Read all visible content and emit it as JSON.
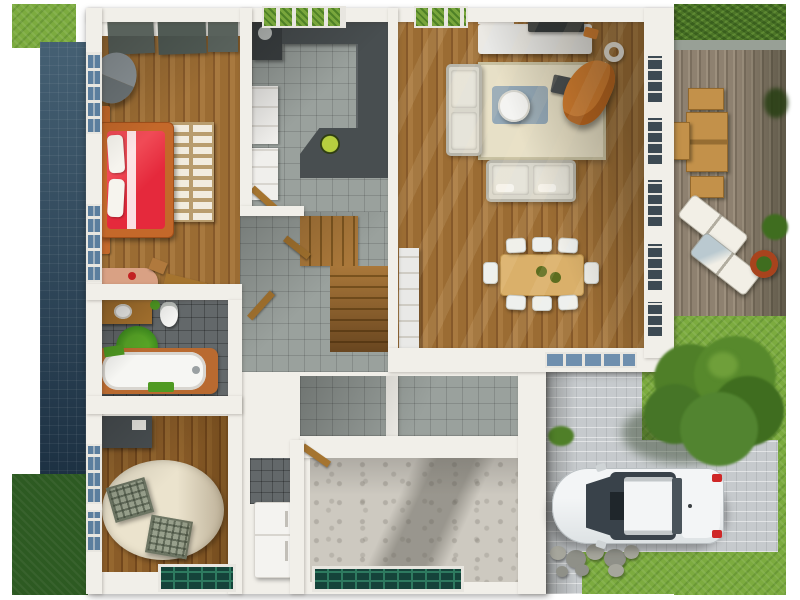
{
  "scene": {
    "type": "3d-floor-plan-render",
    "view": "top-down",
    "description": "Photoreal top-down render of a single-storey house interior with garden, wooden deck, driveway and parked white car",
    "rooms": [
      {
        "name": "bedroom",
        "floor": "wood",
        "furniture": [
          "double-bed-red",
          "nightstand",
          "nightstand",
          "armchair-gray",
          "slatted-dresser",
          "closet-panels",
          "desk",
          "wall-windows"
        ]
      },
      {
        "name": "kitchen",
        "floor": "gray-tile",
        "furniture": [
          "l-shaped-counter-dark",
          "island-dark",
          "white-cabinets",
          "cooktop",
          "green-bowl",
          "garden-windows"
        ]
      },
      {
        "name": "living-room",
        "floor": "wood",
        "furniture": [
          "tv-console",
          "tv",
          "corner-sofa-cream",
          "loveseat-cream",
          "round-coffee-table",
          "beige-rug",
          "blue-mat",
          "orange-chaise",
          "ottoman",
          "speaker-ring"
        ]
      },
      {
        "name": "dining-area",
        "floor": "wood",
        "furniture": [
          "wood-dining-table",
          "white-chairs-x8",
          "green-bowls"
        ]
      },
      {
        "name": "hallway-stairs",
        "floor": "gray-tile",
        "furniture": [
          "l-shaped-wood-staircase",
          "white-sideboard",
          "open-wood-doors"
        ]
      },
      {
        "name": "bathroom",
        "floor": "dark-tile",
        "furniture": [
          "bathtub-wood-surround",
          "vanity-sink",
          "toilet",
          "round-green-rug",
          "green-mat",
          "blue-towels"
        ]
      },
      {
        "name": "office-bedroom2",
        "floor": "wood",
        "furniture": [
          "oval-cream-rug",
          "plaid-chair",
          "plaid-chair",
          "dark-desk",
          "wall-windows",
          "teal-basement-window"
        ]
      },
      {
        "name": "utility-garage",
        "floor": "concrete",
        "furniture": [
          "fridge-white",
          "teal-basement-window"
        ]
      }
    ],
    "outdoor": [
      {
        "name": "hedge-top-right"
      },
      {
        "name": "wood-deck",
        "furniture": [
          "deck-dining-table",
          "deck-chairs-x3",
          "sun-lounger-white",
          "sun-lounger-white",
          "terracotta-planter"
        ]
      },
      {
        "name": "lawn"
      },
      {
        "name": "paver-driveway",
        "furniture": [
          "white-car",
          "stones",
          "tree",
          "bush"
        ]
      },
      {
        "name": "blue-side-strip"
      },
      {
        "name": "grass-corners"
      }
    ]
  },
  "palette": {
    "wall": "#f1efe9",
    "wood-1": "#9b6c33",
    "wood-2": "#86592a",
    "wood-3": "#a8793f",
    "wood-d1": "#8a5c28",
    "wood-d2": "#73481d",
    "wood-d3": "#95672f",
    "tile-gray": "#9aa19d",
    "tile-dark": "#63686a",
    "grass": "#7cab3f",
    "grass-dark": "#2d5a22",
    "hedge": "#4c7527",
    "deck-1": "#8e8170",
    "deck-2": "#9c8f7d",
    "deck-3": "#7a6e5e",
    "deck-table": "#c3914a",
    "deck-table-edge": "#93682c",
    "lounger": "#f2efe6",
    "paver": "#c6cacd",
    "concrete": "#cdc9c0",
    "pool-blue": "#2b4a60",
    "glass-blue": "#5b7e9e",
    "garden-green": "#79a63c",
    "teal-glass": "#15433a",
    "teal-grid": "#2e7a60",
    "window-dark": "#3d4a53",
    "frame": "#e8e6e0",
    "bed-red": "#e5293c",
    "bed-red-light": "#f04a56",
    "bed-frame": "#c4682a",
    "pillow": "#f6f4ee",
    "dresser-tan": "#b99d6e",
    "dresser-slat": "#f2ecdf",
    "closet-panel": "#59625c",
    "armchair-light": "#8d9599",
    "armchair-dark": "#6e7679",
    "desk-pink": "#d9a184",
    "door-wood": "#a5742f",
    "stair-light": "#aa783a",
    "stair-dark": "#7e5620",
    "counter-dark": "#484e50",
    "appliance-dark": "#3a3f41",
    "cabinet-white": "#f0efec",
    "bowl-green": "#b7cf3f",
    "sofa-cream": "#d9d7cc",
    "sofa-light": "#e6e4da",
    "rug-beige": "#e7e0c7",
    "rug-border": "#c9c2a3",
    "mat-blue": "#8ca3b5",
    "table-white": "#f4f4f2",
    "chaise-orange": "#d67e2e",
    "ottoman-dark": "#474d50",
    "console-white": "#e9e9e7",
    "tv-dark": "#31373a",
    "dining-wood": "#dab06a",
    "dining-edge": "#b98d45",
    "chair-white": "#eef0ee",
    "bowl-olive": "#5d6d1f",
    "tub-frame": "#b96a30",
    "tub-white": "#f6f6f3",
    "fixture-white": "#f4f4f2",
    "rug-green": "#3e8c1e",
    "rug-green-light": "#57a426",
    "towel-green": "#4f9a22",
    "vanity-wood": "#a9742f",
    "rug-oval": "#ebe3cd",
    "plaid-base": "#98a08c",
    "plaid-edge": "#6d7563",
    "desk-dark": "#4b5154",
    "fridge-white": "#f4f3f0",
    "fridge-edge": "#d8d5cf",
    "car-body-1": "#f3f5f6",
    "car-body-2": "#dde2e4",
    "car-glass": "#39424a",
    "car-dark": "#1f262b",
    "car-light-red": "#cf2727",
    "stone-1": "#a6a69c",
    "stone-2": "#8f9088",
    "tree-1": "#57892c",
    "tree-2": "#3f6d1f",
    "tree-3": "#4f7f28",
    "planter": "#a8431d",
    "coping": "#98a096"
  }
}
